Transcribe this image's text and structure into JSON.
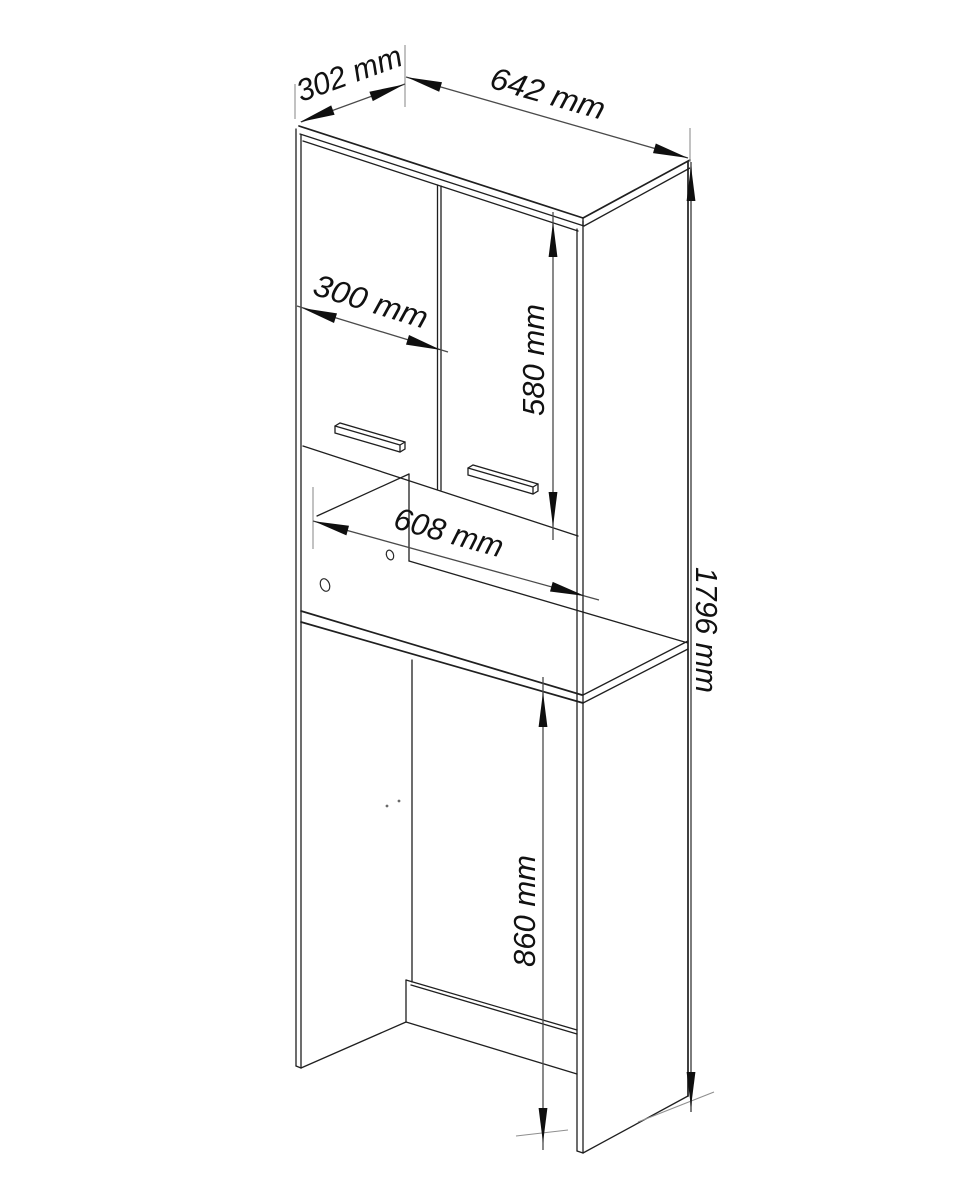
{
  "drawing": {
    "kind": "technical-drawing",
    "view": "isometric cabinet line drawing",
    "dimension_labels": {
      "depth": "302 mm",
      "width": "642 mm",
      "door_width": "300 mm",
      "door_height": "580 mm",
      "niche_width": "608 mm",
      "total_height": "1796 mm",
      "lower_space_height": "860 mm"
    }
  },
  "colors": {
    "background": "#ffffff",
    "edge": "#1f1f1f",
    "dim_line": "#4a4a4a",
    "dim_line_light": "#7d7d7d",
    "extension": "#8f8f8f",
    "arrow": "#0f0f0f",
    "label_text": "#111111"
  }
}
